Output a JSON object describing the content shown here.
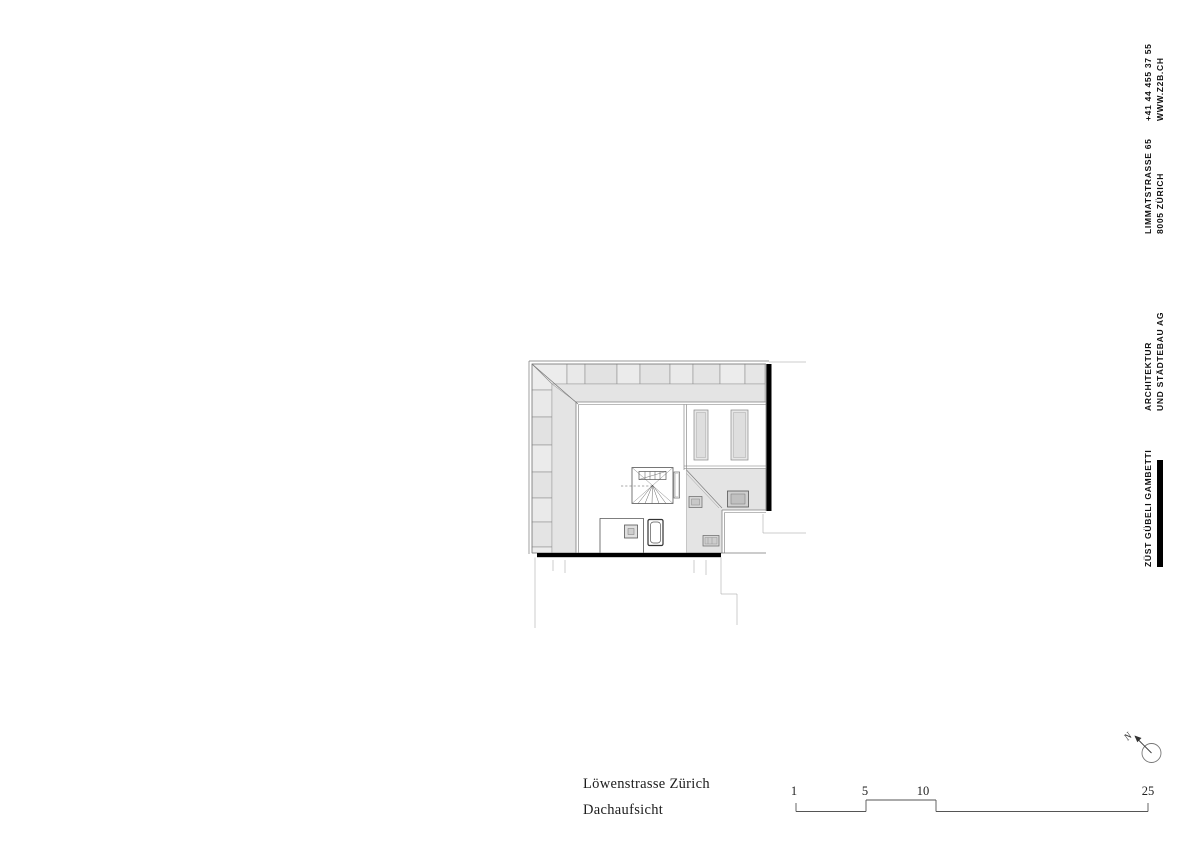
{
  "title_block": {
    "project": "Löwenstrasse Zürich",
    "drawing_name": "Dachaufsicht"
  },
  "firm_block": {
    "name": "ZÜST GÜBELI GAMBETTI",
    "discipline_line1": "ARCHITEKTUR",
    "discipline_line2": "UND STÄDTEBAU AG",
    "street": "LIMMATSTRASSE 65",
    "city": "8005 ZÜRICH",
    "phone": "+41 44 455 37 55",
    "website": "WWW.Z2B.CH",
    "accent_color": "#000000"
  },
  "scale_bar": {
    "labels": [
      "1",
      "5",
      "10",
      "25"
    ]
  },
  "north_arrow": {
    "label": "N"
  }
}
